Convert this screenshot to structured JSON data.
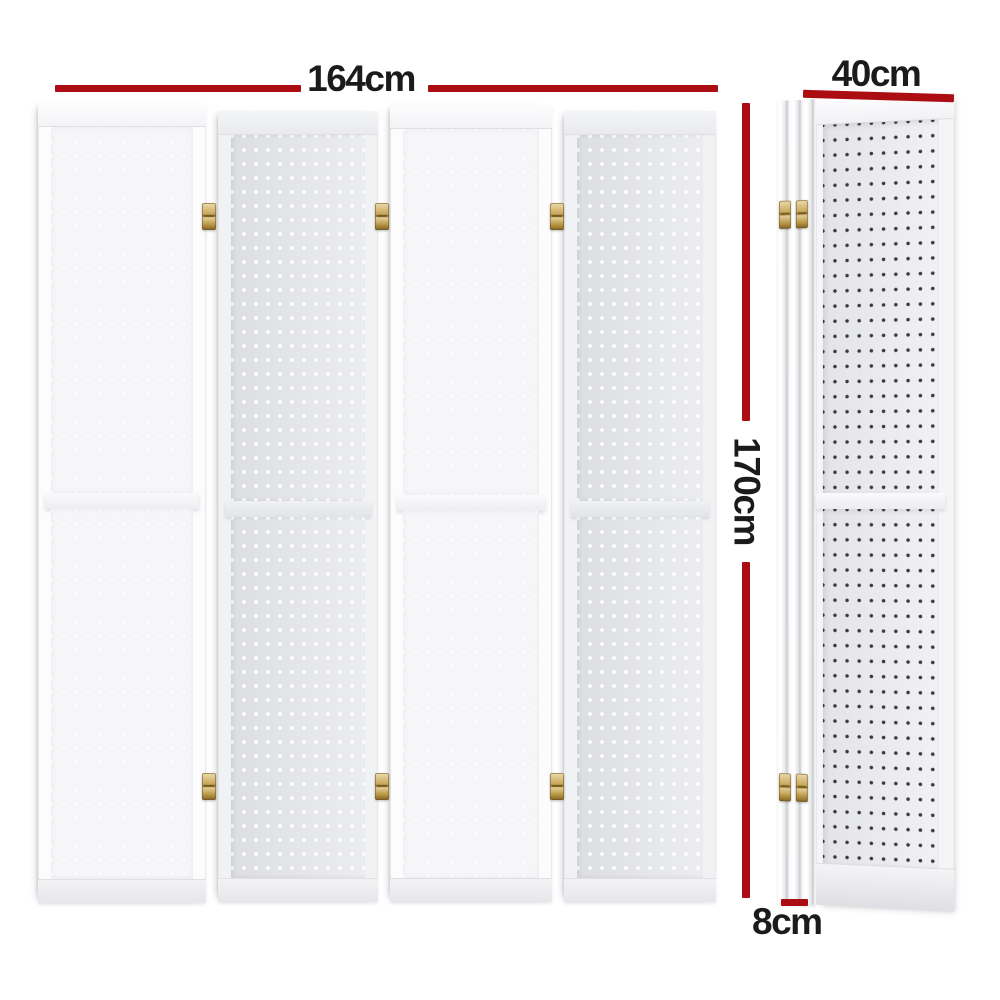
{
  "dimensions": {
    "width": {
      "label": "164cm"
    },
    "depth": {
      "label": "40cm"
    },
    "height": {
      "label": "170cm"
    },
    "thickness": {
      "label": "8cm"
    }
  },
  "figure": {
    "panel_count": 4,
    "views": [
      "front",
      "side"
    ],
    "hinge_count_front": 6,
    "hinge_count_side": 4
  },
  "colors": {
    "dimension_line": "#ac0d13",
    "dimension_text": "#1b1b1b",
    "panel_white": "#f7f7f9",
    "panel_gray": "#e4e5e8",
    "hinge_brass": "#c9a85c",
    "peg_hole_dark": "#3a3a3c"
  }
}
